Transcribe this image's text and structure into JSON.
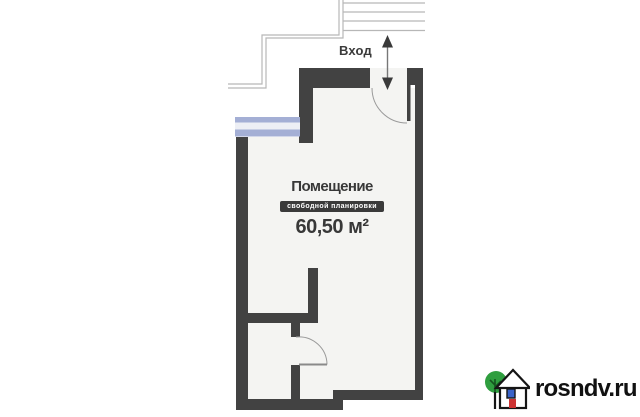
{
  "plan": {
    "entrance_label": "Вход",
    "room": {
      "title": "Помещение",
      "badge": "свободной планировки",
      "area": "60,50 м²"
    },
    "colors": {
      "wall": "#424242",
      "floor": "#f4f4f2",
      "window_band": "#a4afd5",
      "window_gap": "#edeff5",
      "stair_line": "#b7b7b7",
      "door_arc": "#9a9a9a",
      "arrow": "#3a3a3a",
      "text": "#383838",
      "badge_bg": "#3a3a3a",
      "badge_text": "#ffffff"
    }
  },
  "watermark": {
    "site": "rosndv.ru",
    "colors": {
      "text": "#111111",
      "tree": "#2f9e3f",
      "tree_branches": "#14531f",
      "house_outline": "#151515",
      "window": "#3a63c8",
      "door": "#cc3333"
    }
  }
}
